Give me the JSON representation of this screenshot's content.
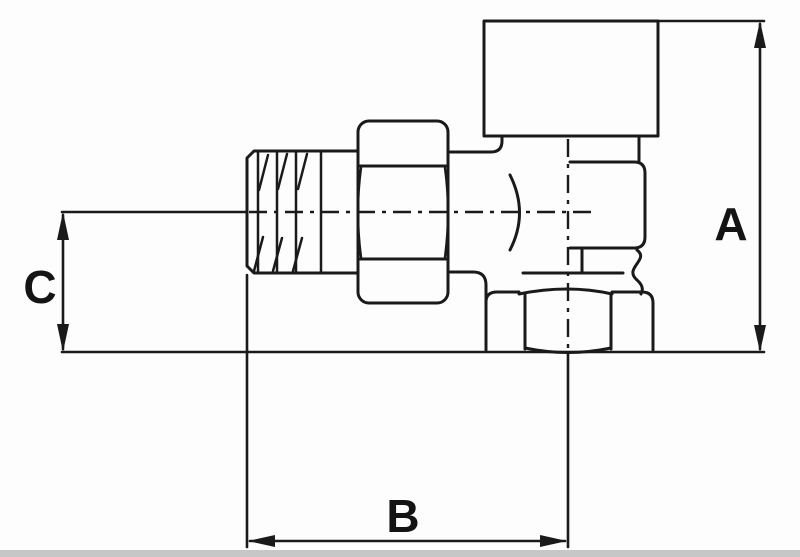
{
  "page": {
    "background_color": "#fdfdfd",
    "footer_strip_color": "#c7c7c7"
  },
  "drawing": {
    "description": "Technical line drawing (side elevation) of an angle valve: male threaded end, union hex nut, valve body with cap, bottom hex outlet, with dimension callouts",
    "line_color": "#1a1a1a",
    "labels": {
      "a": "A",
      "b": "B",
      "c": "C"
    }
  }
}
